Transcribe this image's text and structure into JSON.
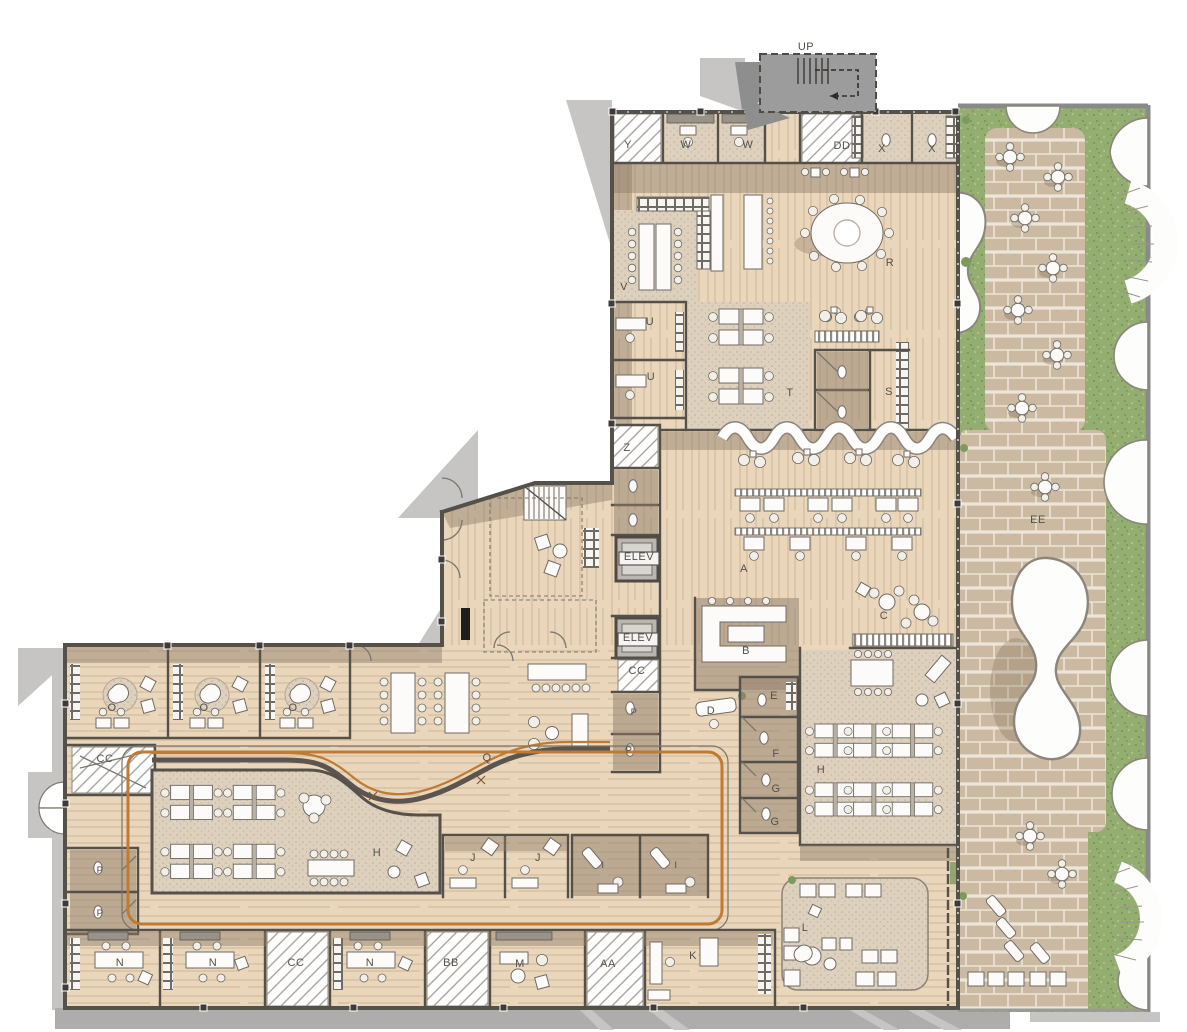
{
  "document": {
    "kind": "architectural-floor-plan",
    "level": "ground floor with roof garden terraces"
  },
  "palette": {
    "background": "#ffffff",
    "wood": "#e9d6bb",
    "rug": "#ddd1be",
    "wall_dark": "#54504a",
    "wall_gray": "#908d89",
    "shadow_taupe": "#8f7c69",
    "shadow_gray": "#c6c5c3",
    "accent_orange": "#bf7a33",
    "grass": "#94ae72",
    "paver": "#cbbaa1",
    "grout": "#ece5d8",
    "furniture_white": "#fcfbf9",
    "outline_gray": "#6f6a64",
    "hatch": "#a39d96",
    "label_color": "#55504a"
  },
  "rooms": [
    {
      "id": "up-stair",
      "label": "UP",
      "x": 806,
      "y": 50
    },
    {
      "id": "y",
      "label": "Y",
      "x": 628,
      "y": 148
    },
    {
      "id": "w-1",
      "label": "W",
      "x": 686,
      "y": 148
    },
    {
      "id": "w-2",
      "label": "W",
      "x": 748,
      "y": 148
    },
    {
      "id": "dd",
      "label": "DD",
      "x": 842,
      "y": 149
    },
    {
      "id": "x-1",
      "label": "X",
      "x": 882,
      "y": 152
    },
    {
      "id": "x-2",
      "label": "X",
      "x": 932,
      "y": 152
    },
    {
      "id": "r",
      "label": "R",
      "x": 890,
      "y": 266
    },
    {
      "id": "v",
      "label": "V",
      "x": 624,
      "y": 290
    },
    {
      "id": "u-1",
      "label": "U",
      "x": 650,
      "y": 325
    },
    {
      "id": "u-2",
      "label": "U",
      "x": 651,
      "y": 380
    },
    {
      "id": "t",
      "label": "T",
      "x": 790,
      "y": 396
    },
    {
      "id": "s",
      "label": "S",
      "x": 889,
      "y": 395
    },
    {
      "id": "z",
      "label": "Z",
      "x": 627,
      "y": 451
    },
    {
      "id": "elev-1",
      "label": "ELEV",
      "x": 639,
      "y": 560
    },
    {
      "id": "a",
      "label": "A",
      "x": 744,
      "y": 572
    },
    {
      "id": "elev-2",
      "label": "ELEV",
      "x": 638,
      "y": 641
    },
    {
      "id": "cc-1",
      "label": "CC",
      "x": 637,
      "y": 674
    },
    {
      "id": "b",
      "label": "B",
      "x": 746,
      "y": 654
    },
    {
      "id": "c",
      "label": "C",
      "x": 884,
      "y": 619
    },
    {
      "id": "d",
      "label": "D",
      "x": 711,
      "y": 714
    },
    {
      "id": "e",
      "label": "E",
      "x": 774,
      "y": 699
    },
    {
      "id": "f",
      "label": "F",
      "x": 776,
      "y": 757
    },
    {
      "id": "g-1",
      "label": "G",
      "x": 776,
      "y": 792
    },
    {
      "id": "g-2",
      "label": "G",
      "x": 775,
      "y": 825
    },
    {
      "id": "h-1",
      "label": "H",
      "x": 821,
      "y": 773
    },
    {
      "id": "p-1",
      "label": "P",
      "x": 634,
      "y": 715
    },
    {
      "id": "p-2",
      "label": "P",
      "x": 629,
      "y": 753
    },
    {
      "id": "o-1",
      "label": "O",
      "x": 112,
      "y": 711
    },
    {
      "id": "o-2",
      "label": "O",
      "x": 204,
      "y": 711
    },
    {
      "id": "o-3",
      "label": "O",
      "x": 293,
      "y": 711
    },
    {
      "id": "cc-2",
      "label": "CC",
      "x": 105,
      "y": 762
    },
    {
      "id": "q",
      "label": "Q",
      "x": 487,
      "y": 761
    },
    {
      "id": "p-3",
      "label": "P",
      "x": 100,
      "y": 873
    },
    {
      "id": "p-4",
      "label": "P",
      "x": 100,
      "y": 916
    },
    {
      "id": "h-2",
      "label": "H",
      "x": 377,
      "y": 856
    },
    {
      "id": "j-1",
      "label": "J",
      "x": 473,
      "y": 861
    },
    {
      "id": "j-2",
      "label": "J",
      "x": 538,
      "y": 861
    },
    {
      "id": "i-1",
      "label": "I",
      "x": 603,
      "y": 868
    },
    {
      "id": "i-2",
      "label": "I",
      "x": 676,
      "y": 868
    },
    {
      "id": "n-1",
      "label": "N",
      "x": 120,
      "y": 966
    },
    {
      "id": "n-2",
      "label": "N",
      "x": 213,
      "y": 966
    },
    {
      "id": "cc-3",
      "label": "CC",
      "x": 296,
      "y": 966
    },
    {
      "id": "n-3",
      "label": "N",
      "x": 370,
      "y": 966
    },
    {
      "id": "bb",
      "label": "BB",
      "x": 451,
      "y": 966
    },
    {
      "id": "m",
      "label": "M",
      "x": 520,
      "y": 967
    },
    {
      "id": "aa",
      "label": "AA",
      "x": 608,
      "y": 967
    },
    {
      "id": "k",
      "label": "K",
      "x": 693,
      "y": 959
    },
    {
      "id": "l",
      "label": "L",
      "x": 805,
      "y": 931
    },
    {
      "id": "ee",
      "label": "EE",
      "x": 1038,
      "y": 523
    }
  ]
}
